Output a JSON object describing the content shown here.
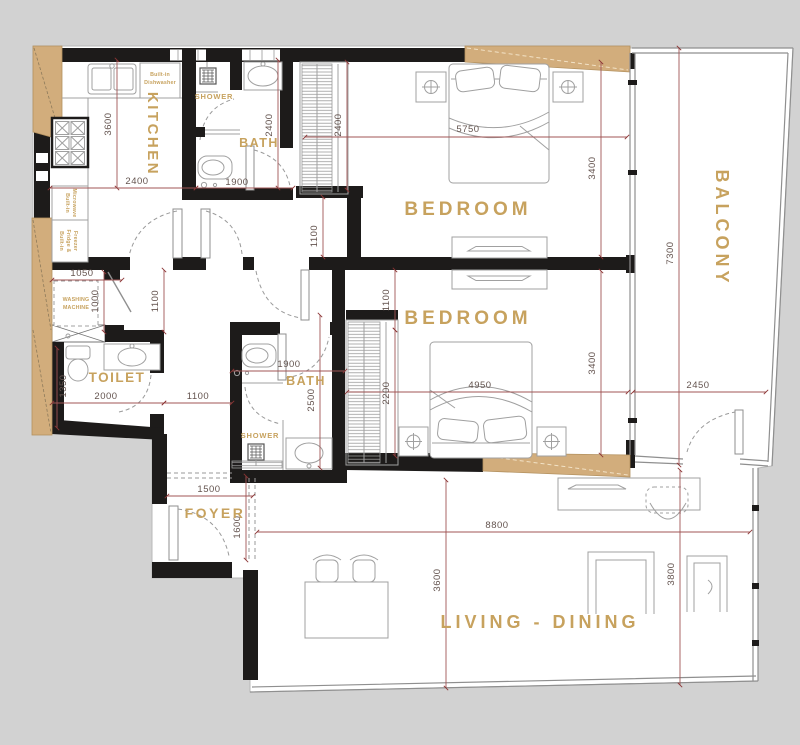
{
  "plan_title": "apartment-floor-plan",
  "colors": {
    "background": "#d2d2d2",
    "floor": "#ffffff",
    "wall": "#1d1b1a",
    "column_tan": "#d2ad7c",
    "label_gold": "#c7a25e",
    "dimension_line": "#a05454",
    "dimension_text": "#64544f",
    "furniture_line": "#a0a0a0"
  },
  "rooms": {
    "kitchen": "KITCHEN",
    "bath_top": "BATH",
    "shower_top": "SHOWER",
    "bedroom_top": "BEDROOM",
    "balcony": "BALCONY",
    "bedroom_mid": "BEDROOM",
    "toilet": "TOILET",
    "bath_mid": "BATH",
    "shower_mid": "SHOWER",
    "foyer": "FOYER",
    "living": "LIVING - DINING"
  },
  "appliances": {
    "dishwasher_line1": "Built-in",
    "dishwasher_line2": "Dishwasher",
    "microwave_line1": "Built-in",
    "microwave_line2": "Microwave",
    "fridge_line1": "Built-in",
    "fridge_line2": "Fridge &",
    "fridge_line3": "Freezer",
    "washing_line1": "WASHING",
    "washing_line2": "MACHINE"
  },
  "dims": {
    "kitchen_depth": {
      "value": "3600"
    },
    "kitchen_width": {
      "value": "2400"
    },
    "bath_top_depth": {
      "value": "2400"
    },
    "bath_top_width": {
      "value": "1900"
    },
    "wardrobe_top": {
      "value": "2400"
    },
    "bedroom_top_width": {
      "value": "5750"
    },
    "bedroom_top_depth": {
      "value": "3400"
    },
    "balcony_length": {
      "value": "7300"
    },
    "hall_top": {
      "value": "1100"
    },
    "closet_width": {
      "value": "1050"
    },
    "closet_depth": {
      "value": "1000"
    },
    "hall_left": {
      "value": "1100"
    },
    "toilet_depth": {
      "value": "1350"
    },
    "toilet_width": {
      "value": "2000"
    },
    "hall_width": {
      "value": "1100"
    },
    "bath_mid_width": {
      "value": "1900"
    },
    "bath_mid_depth": {
      "value": "2500"
    },
    "bedroom_mid_nook": {
      "value": "1100"
    },
    "wardrobe_mid": {
      "value": "2200"
    },
    "bedroom_mid_width": {
      "value": "4950"
    },
    "bedroom_mid_depth": {
      "value": "3400"
    },
    "balcony_width": {
      "value": "2450"
    },
    "foyer_width": {
      "value": "1500"
    },
    "foyer_depth": {
      "value": "1600"
    },
    "living_width": {
      "value": "8800"
    },
    "living_depth": {
      "value": "3600"
    },
    "living_right_depth": {
      "value": "3800"
    }
  }
}
